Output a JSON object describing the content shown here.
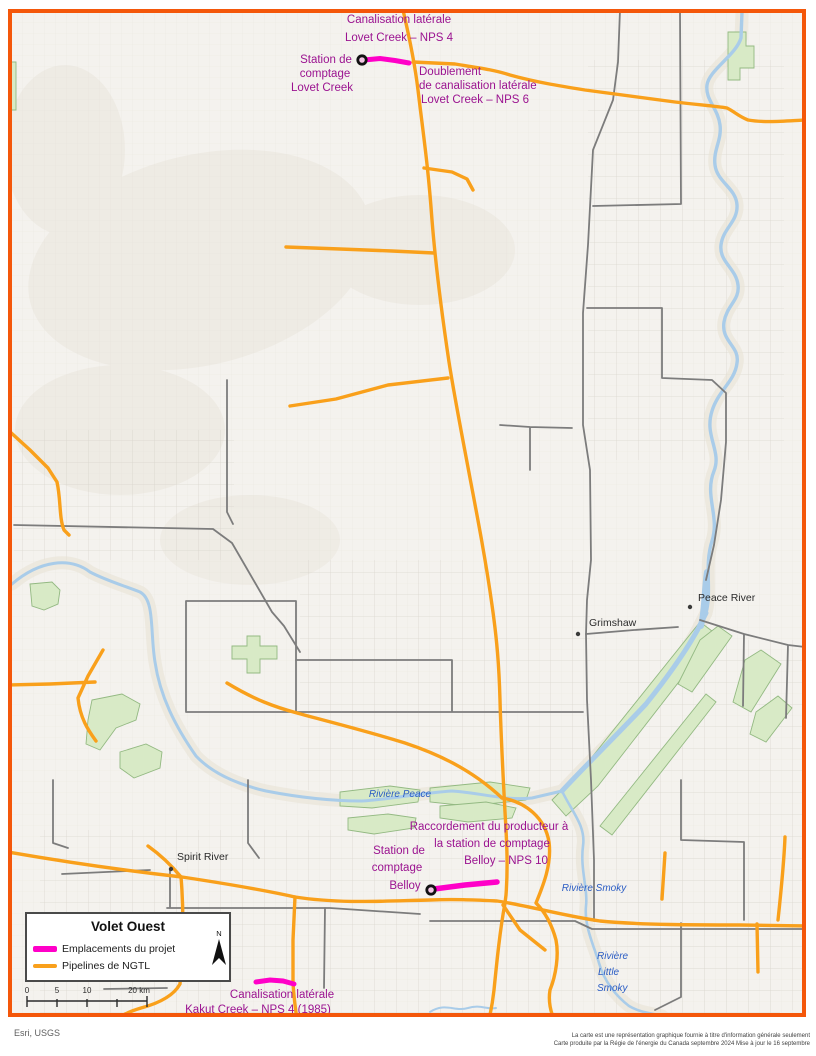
{
  "map_title_implicit": "Volet Ouest pipeline project map",
  "colors": {
    "border": "#F4570A",
    "pipeline_ngtl": "#F9A01B",
    "project_magenta": "#FF00C8",
    "annotation_purple": "#9B1390",
    "river_blue": "#A9CCE9",
    "river_label_blue": "#2A5CC4",
    "green_area": "#D8EAC6",
    "road_gray": "#7C7C7C"
  },
  "annotations": {
    "lovet_lateral": [
      "Canalisation latérale",
      "Lovet Creek – NPS 4"
    ],
    "lovet_station": [
      "Station de",
      "comptage",
      "Lovet Creek"
    ],
    "lovet_doublement": [
      "Doublement",
      "de canalisation latérale",
      "Lovet Creek – NPS 6"
    ],
    "belloy_racc": [
      "Raccordement du producteur à",
      "la station de comptage",
      "Belloy – NPS 10"
    ],
    "belloy_station": [
      "Station de",
      "comptage",
      "Belloy"
    ],
    "kakut": [
      "Canalisation latérale",
      "Kakut Creek – NPS 4 (1985)"
    ]
  },
  "towns": {
    "peace_river": "Peace River",
    "grimshaw": "Grimshaw",
    "spirit_river": "Spirit River"
  },
  "rivers": {
    "peace": "Rivière Peace",
    "smoky": "Rivière Smoky",
    "little_smoky": [
      "Rivière",
      "Little",
      "Smoky"
    ]
  },
  "legend": {
    "title": "Volet Ouest",
    "items": [
      {
        "label": "Emplacements du projet",
        "color": "#FF00C8"
      },
      {
        "label": "Pipelines de NGTL",
        "color": "#F9A01B"
      }
    ],
    "north_label": "N"
  },
  "scalebar": {
    "labels": [
      "0",
      "5",
      "10",
      "20 km"
    ]
  },
  "credit": "Esri, USGS",
  "disclaimer": [
    "La carte est une représentation graphique fournie à titre d'information générale seulement",
    "Carte produite par la Régie de l'énergie du Canada  septembre 2024   Mise à jour le 16 septembre"
  ]
}
